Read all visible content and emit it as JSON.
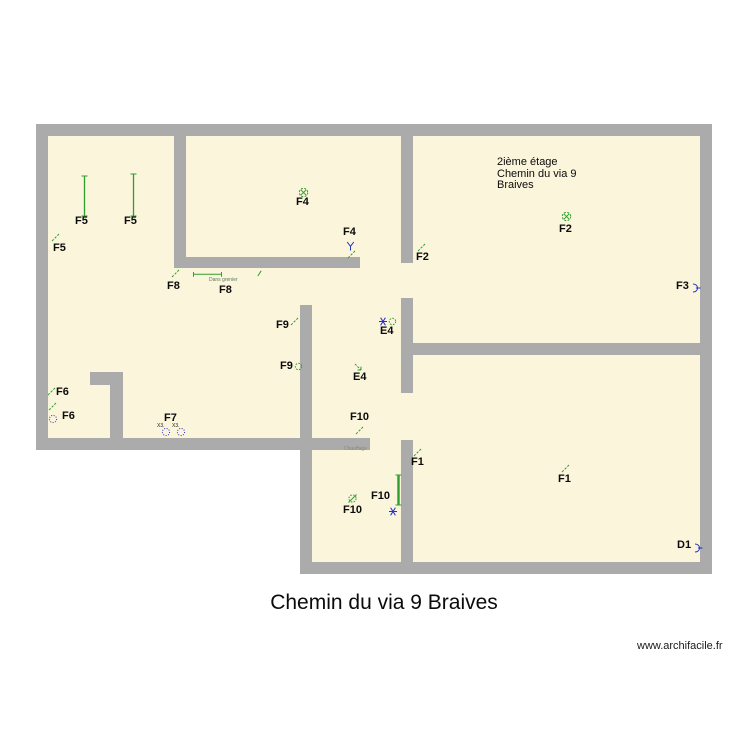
{
  "title": "Chemin du via 9 Braives",
  "watermark": "www.archifacile.fr",
  "room_note": {
    "lines": [
      "2ième étage",
      "Chemin du via 9",
      "Braives"
    ]
  },
  "colors": {
    "floor": "#FBF5DC",
    "wall": "#ABABAB",
    "green": "#2F9E2F",
    "blue": "#2433C8",
    "label": "#0B0B0B"
  },
  "plan": {
    "floors": [
      {
        "x": 36,
        "y": 124,
        "w": 676,
        "h": 326
      },
      {
        "x": 300,
        "y": 437,
        "w": 412,
        "h": 137
      }
    ],
    "walls": [
      {
        "x": 36,
        "y": 124,
        "w": 676,
        "h": 12
      },
      {
        "x": 36,
        "y": 124,
        "w": 12,
        "h": 326
      },
      {
        "x": 700,
        "y": 124,
        "w": 12,
        "h": 450
      },
      {
        "x": 36,
        "y": 438,
        "w": 334,
        "h": 12
      },
      {
        "x": 300,
        "y": 562,
        "w": 412,
        "h": 12
      },
      {
        "x": 300,
        "y": 305,
        "w": 12,
        "h": 269
      },
      {
        "x": 174,
        "y": 124,
        "w": 12,
        "h": 144
      },
      {
        "x": 174,
        "y": 257,
        "w": 186,
        "h": 11
      },
      {
        "x": 401,
        "y": 124,
        "w": 12,
        "h": 139
      },
      {
        "x": 401,
        "y": 298,
        "w": 12,
        "h": 95
      },
      {
        "x": 401,
        "y": 343,
        "w": 311,
        "h": 12
      },
      {
        "x": 401,
        "y": 440,
        "w": 12,
        "h": 134
      },
      {
        "x": 90,
        "y": 372,
        "w": 33,
        "h": 13
      },
      {
        "x": 110,
        "y": 372,
        "w": 13,
        "h": 77
      }
    ],
    "labels": [
      {
        "text": "F5",
        "x": 75,
        "y": 215
      },
      {
        "text": "F5",
        "x": 124,
        "y": 215
      },
      {
        "text": "F5",
        "x": 53,
        "y": 242
      },
      {
        "text": "F4",
        "x": 296,
        "y": 196
      },
      {
        "text": "F4",
        "x": 343,
        "y": 226
      },
      {
        "text": "F2",
        "x": 416,
        "y": 251
      },
      {
        "text": "F2",
        "x": 559,
        "y": 223
      },
      {
        "text": "F3",
        "x": 676,
        "y": 280
      },
      {
        "text": "F8",
        "x": 167,
        "y": 280
      },
      {
        "text": "F8",
        "x": 219,
        "y": 284
      },
      {
        "text": "F9",
        "x": 276,
        "y": 319
      },
      {
        "text": "F9",
        "x": 280,
        "y": 360
      },
      {
        "text": "E4",
        "x": 380,
        "y": 325
      },
      {
        "text": "E4",
        "x": 353,
        "y": 371
      },
      {
        "text": "F6",
        "x": 56,
        "y": 386
      },
      {
        "text": "F6",
        "x": 62,
        "y": 410
      },
      {
        "text": "F7",
        "x": 164,
        "y": 412
      },
      {
        "text": "F10",
        "x": 350,
        "y": 411
      },
      {
        "text": "F10",
        "x": 371,
        "y": 490
      },
      {
        "text": "F10",
        "x": 343,
        "y": 504
      },
      {
        "text": "F1",
        "x": 411,
        "y": 456
      },
      {
        "text": "F1",
        "x": 558,
        "y": 473
      },
      {
        "text": "D1",
        "x": 677,
        "y": 539
      }
    ],
    "annotations": [
      {
        "text": "Dans grenier",
        "x": 209,
        "y": 277,
        "size": 5,
        "color": "#5A7A5A"
      },
      {
        "text": "Chauffage",
        "x": 344,
        "y": 446,
        "size": 5,
        "color": "#8A8878"
      },
      {
        "text": "X3.",
        "x": 157,
        "y": 423,
        "size": 5,
        "color": "#222222"
      },
      {
        "text": "X3.",
        "x": 172,
        "y": 423,
        "size": 5,
        "color": "#222222"
      }
    ],
    "symbols": [
      {
        "type": "vline",
        "x": 80,
        "y": 174,
        "h": 40
      },
      {
        "type": "vline",
        "x": 129,
        "y": 172,
        "h": 42
      },
      {
        "type": "switch",
        "x": 51,
        "y": 233
      },
      {
        "type": "light",
        "x": 298,
        "y": 187
      },
      {
        "type": "y",
        "x": 346,
        "y": 241
      },
      {
        "type": "switch",
        "x": 347,
        "y": 250
      },
      {
        "type": "switch",
        "x": 417,
        "y": 243
      },
      {
        "type": "light",
        "x": 561,
        "y": 211
      },
      {
        "type": "outlet",
        "x": 691,
        "y": 283
      },
      {
        "type": "switch",
        "x": 171,
        "y": 269
      },
      {
        "type": "hdim",
        "x": 193,
        "y": 271,
        "w": 29
      },
      {
        "type": "tick",
        "x": 257,
        "y": 270
      },
      {
        "type": "switch",
        "x": 290,
        "y": 317
      },
      {
        "type": "gcircle",
        "x": 294,
        "y": 362
      },
      {
        "type": "star",
        "x": 378,
        "y": 316
      },
      {
        "type": "gcircle",
        "x": 388,
        "y": 317
      },
      {
        "type": "arrow",
        "x": 353,
        "y": 362
      },
      {
        "type": "switch",
        "x": 47,
        "y": 387
      },
      {
        "type": "switch",
        "x": 48,
        "y": 402
      },
      {
        "type": "dotcircle",
        "x": 48,
        "y": 414
      },
      {
        "type": "dotcircle",
        "x": 161,
        "y": 427
      },
      {
        "type": "dotcircle",
        "x": 176,
        "y": 427
      },
      {
        "type": "switch",
        "x": 355,
        "y": 426
      },
      {
        "type": "vline",
        "x": 394,
        "y": 473,
        "h": 30,
        "bold": true
      },
      {
        "type": "gcircle-sw",
        "x": 347,
        "y": 493
      },
      {
        "type": "star",
        "x": 388,
        "y": 506
      },
      {
        "type": "switch",
        "x": 413,
        "y": 448
      },
      {
        "type": "switch",
        "x": 561,
        "y": 464
      },
      {
        "type": "outlet",
        "x": 693,
        "y": 543
      }
    ]
  }
}
